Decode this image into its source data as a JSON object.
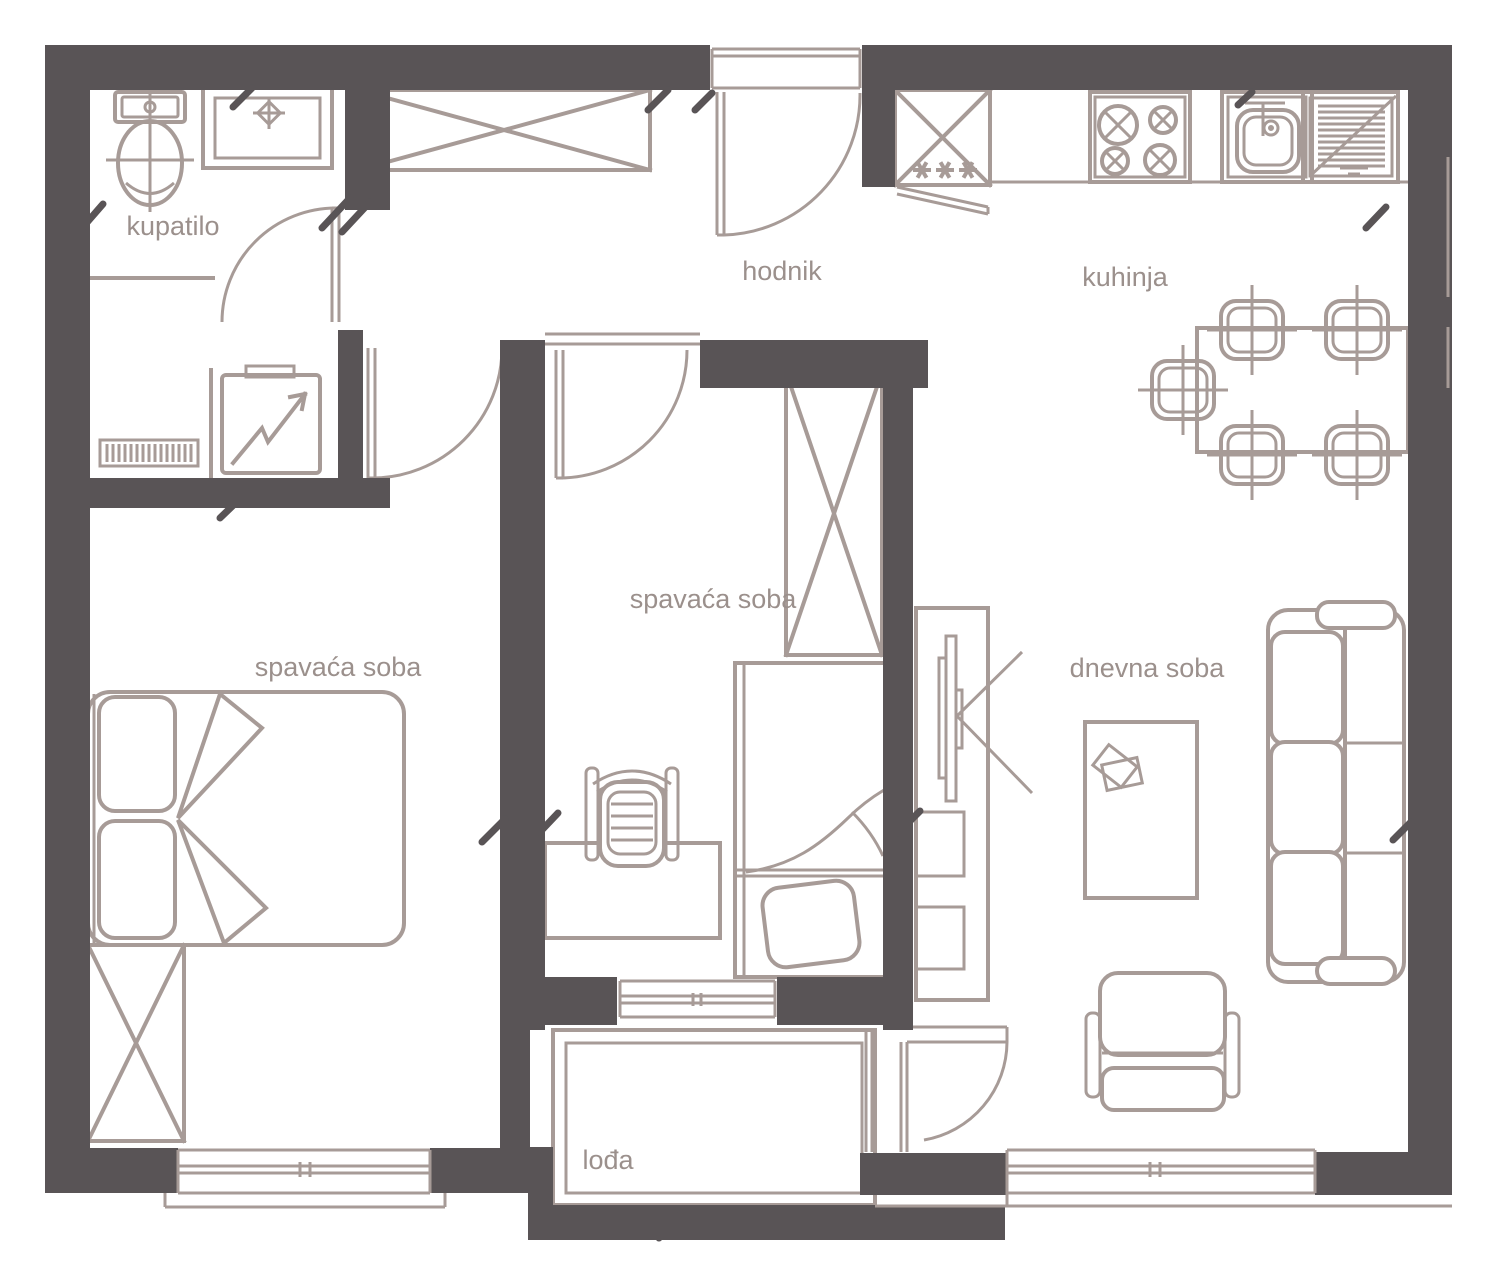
{
  "colors": {
    "wall": "#595456",
    "line": "#a79b97",
    "text": "#9b908c",
    "bg": "#ffffff"
  },
  "rooms": {
    "bathroom": {
      "label": "kupatilo"
    },
    "hallway": {
      "label": "hodnik"
    },
    "kitchen": {
      "label": "kuhinja"
    },
    "bedroom_1": {
      "label": "spavaća soba"
    },
    "bedroom_2": {
      "label": "spavaća soba"
    },
    "living_room": {
      "label": "dnevna soba"
    },
    "loggia": {
      "label": "lođa"
    }
  },
  "furniture_icons": [
    "toilet",
    "washbasin",
    "radiator",
    "washing-machine",
    "hallway-wardrobe",
    "entrance-door",
    "fridge",
    "stove",
    "kitchen-sink",
    "dish-drainer",
    "dining-table",
    "dining-chair",
    "double-bed",
    "bedroom-wardrobe",
    "single-bed",
    "desk",
    "office-chair",
    "tv-stand",
    "tv",
    "coffee-table",
    "sofa",
    "armchair",
    "loggia-door",
    "window"
  ]
}
